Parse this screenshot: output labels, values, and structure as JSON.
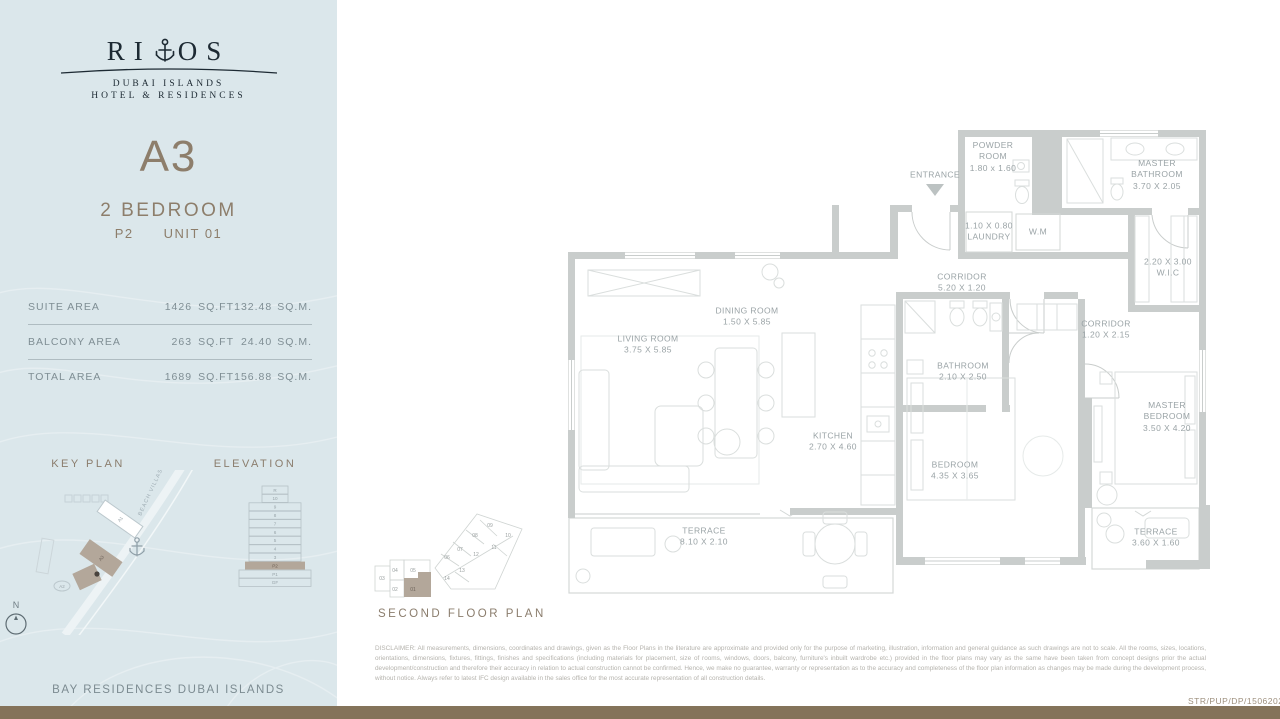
{
  "brand": {
    "wordmark_left": "RI",
    "wordmark_right": "OS",
    "anchor_icon": "anchor-icon",
    "tagline1": "DUBAI ISLANDS",
    "tagline2": "HOTEL & RESIDENCES"
  },
  "unit": {
    "code": "A3",
    "type": "2 BEDROOM",
    "level": "P2",
    "number": "UNIT 01"
  },
  "area_table": {
    "rows": [
      {
        "label": "SUITE AREA",
        "imperial_value": "1426",
        "imperial_unit": "SQ.FT",
        "metric_value": "132.48",
        "metric_unit": "SQ.M."
      },
      {
        "label": "BALCONY AREA",
        "imperial_value": "263",
        "imperial_unit": "SQ.FT",
        "metric_value": "24.40",
        "metric_unit": "SQ.M."
      },
      {
        "label": "TOTAL AREA",
        "imperial_value": "1689",
        "imperial_unit": "SQ.FT",
        "metric_value": "156.88",
        "metric_unit": "SQ.M."
      }
    ]
  },
  "key_plan": {
    "title": "KEY PLAN",
    "road_label": "BEACH VILLAS",
    "building_a1": "A1",
    "building_a2": "A2",
    "building_a3": "A3"
  },
  "elevation": {
    "title": "ELEVATION",
    "floors": [
      "R",
      "10",
      "9",
      "8",
      "7",
      "6",
      "5",
      "4",
      "3",
      "P2",
      "P1",
      "GF"
    ],
    "highlighted_floor": "P2"
  },
  "compass": {
    "north_label": "N"
  },
  "project_footer": "BAY RESIDENCES DUBAI ISLANDS",
  "plan": {
    "entrance": "ENTRANCE",
    "powder_room": {
      "name": "POWDER ROOM",
      "dims": "1.80 x 1.60"
    },
    "master_bathroom": {
      "name": "MASTER BATHROOM",
      "dims": "3.70 X 2.05"
    },
    "laundry": {
      "dims": "1.10 X 0.80",
      "name": "LAUNDRY"
    },
    "washing_machine": {
      "name": "W.M"
    },
    "wic": {
      "dims": "2.20 X 3.00",
      "name": "W.I.C"
    },
    "corridor_main": {
      "name": "CORRIDOR",
      "dims": "5.20 X 1.20"
    },
    "corridor_master": {
      "name": "CORRIDOR",
      "dims": "1.20 X 2.15"
    },
    "dining_room": {
      "name": "DINING ROOM",
      "dims": "1.50 X 5.85"
    },
    "living_room": {
      "name": "LIVING ROOM",
      "dims": "3.75 X 5.85"
    },
    "kitchen": {
      "name": "KITCHEN",
      "dims": "2.70 X 4.60"
    },
    "bathroom": {
      "name": "BATHROOM",
      "dims": "2.10 X 2.50"
    },
    "bedroom": {
      "name": "BEDROOM",
      "dims": "4.35 X 3.65"
    },
    "master_bedroom": {
      "name": "MASTER BEDROOM",
      "dims": "3.50 X 4.20"
    },
    "terrace_main": {
      "name": "TERRACE",
      "dims": "8.10 X 2.10"
    },
    "terrace_master": {
      "name": "TERRACE",
      "dims": "3.60 X 1.60"
    }
  },
  "mini_plan": {
    "caption": "SECOND FLOOR PLAN",
    "units": [
      "01",
      "02",
      "03",
      "04",
      "05",
      "06",
      "07",
      "08",
      "09",
      "10",
      "11",
      "12",
      "13",
      "14"
    ],
    "highlighted_unit": "01"
  },
  "disclaimer": "DISCLAIMER: All measurements, dimensions, coordinates and drawings, given as the Floor Plans in the literature are approximate and provided only for the purpose of marketing, illustration, information and general guidance as such drawings are not to scale. All the rooms, sizes, locations, orientations, dimensions, fixtures, fittings, finishes and specifications (including materials for placement, size of rooms, windows, doors, balcony, furniture's inbuilt wardrobe etc.) provided in the floor plans may vary as the same have been taken from concept designs prior the actual development/construction and therefore their accuracy in relation to actual construction cannot be confirmed. Hence, we make no guarantee, warranty or representation as to the accuracy and completeness of the floor plan information as changes may be made during the development process, without notice. Always refer to latest IFC design available in the sales office for the most accurate representation of all construction details.",
  "reference_code": "STR/PUP/DP/15062023",
  "colors": {
    "accent_taupe": "#b3a79a",
    "sidebar_blue": "#dbe7eb",
    "wall_gray": "#c9cdcc",
    "brand_dark": "#1d2a33",
    "bottom_bar_brown": "#84735a"
  }
}
